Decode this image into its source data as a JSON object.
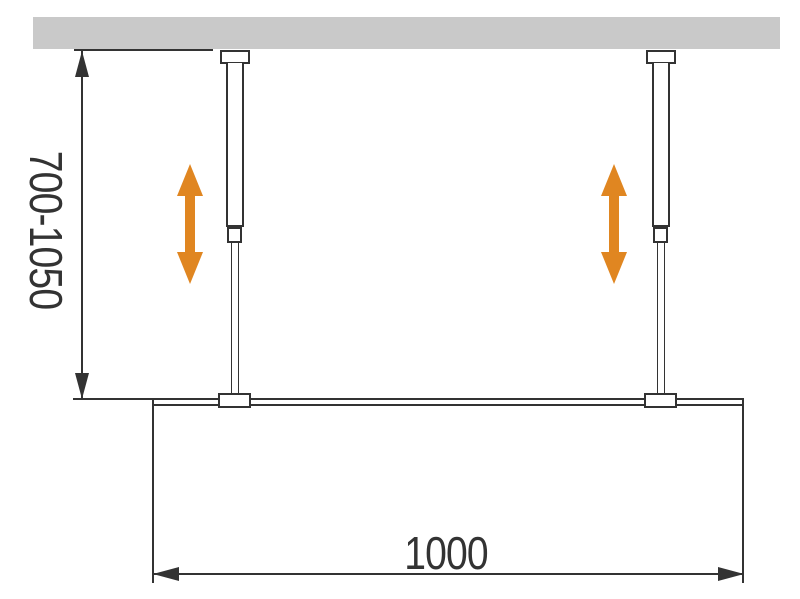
{
  "dimensions": {
    "vertical": {
      "label": "700-1050"
    },
    "horizontal": {
      "label": "1000"
    }
  },
  "colors": {
    "ceiling": "#c9c9c9",
    "line": "#333333",
    "accent": "#e08621",
    "fill": "#ffffff",
    "background": "#ffffff"
  },
  "icons": {
    "adjustability": "double-vertical-arrow-icon",
    "dimension_arrowheads": [
      "arrowhead-up-icon",
      "arrowhead-down-icon",
      "arrowhead-left-icon",
      "arrowhead-right-icon"
    ]
  }
}
